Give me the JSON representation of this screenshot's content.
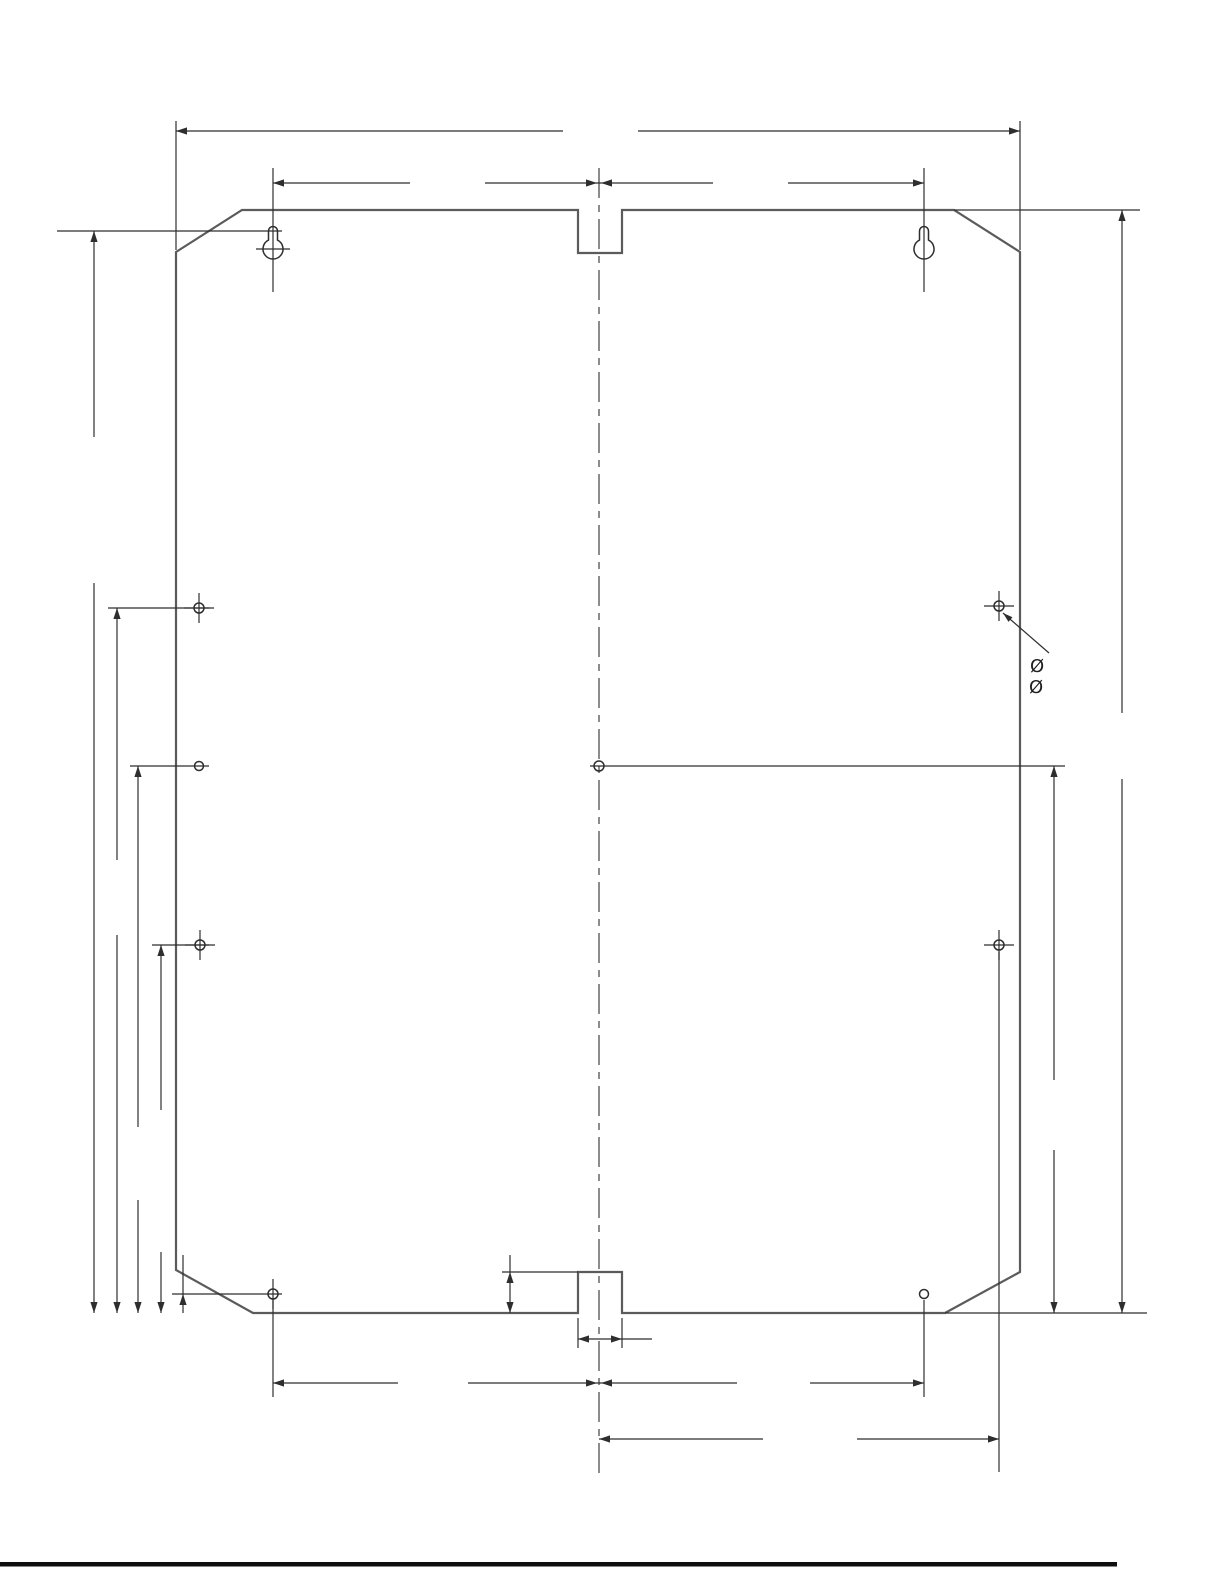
{
  "page": {
    "background": "#ffffff",
    "footer_rule_color": "#0f0f0f"
  },
  "drawing": {
    "kind": "technical-dimension-drawing",
    "description": "Rear mounting plate with two keyhole slots at top, alignment notches at top and bottom center, chamfered corners, eight mounting holes and unlabeled dimension lines",
    "outline_color": "#5b5b5b",
    "dimension_line_color": "#2e2e2e",
    "features": {
      "keyhole_slots": 2,
      "round_holes": 8,
      "notches": 2,
      "chamfered_corners": 4
    }
  },
  "annotations": {
    "diameter_symbols": [
      {
        "text": "Ø"
      },
      {
        "text": "Ø"
      }
    ]
  }
}
